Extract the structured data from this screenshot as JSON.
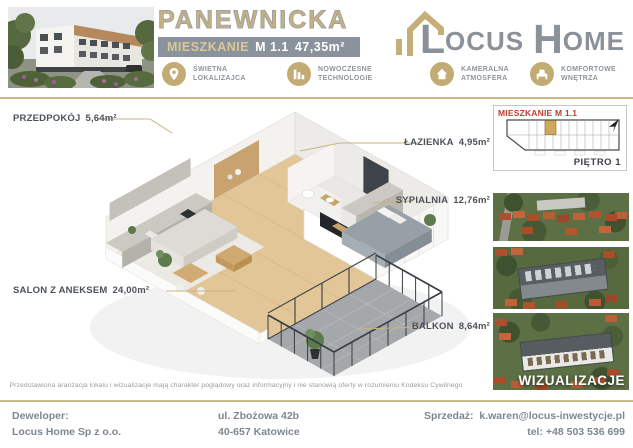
{
  "header": {
    "project_title": "PANEWNICKA",
    "unit_bar": {
      "label": "MIESZKANIE",
      "unit": "M 1.1",
      "area": "47,35m²"
    },
    "logo": {
      "l": "L",
      "ocus": "OCUS",
      "h": "H",
      "ome": "OME"
    },
    "features": [
      {
        "icon": "location-pin-icon",
        "line1": "ŚWIETNA",
        "line2": "LOKALIZAJCA"
      },
      {
        "icon": "bar-chart-icon",
        "line1": "NOWOCZESNE",
        "line2": "TECHNOLOGIE"
      },
      {
        "icon": "house-icon",
        "line1": "KAMERALNA",
        "line2": "ATMOSFERA"
      },
      {
        "icon": "armchair-icon",
        "line1": "KOMFORTOWE",
        "line2": "WNĘTRZA"
      }
    ]
  },
  "floorplan": {
    "labels": [
      {
        "name": "PRZEDPOKÓJ",
        "area": "5,64m²"
      },
      {
        "name": "ŁAZIENKA",
        "area": "4,95m²"
      },
      {
        "name": "SYPIALNIA",
        "area": "12,76m²"
      },
      {
        "name": "SALON Z ANEKSEM",
        "area": "24,00m²"
      },
      {
        "name": "BALKON",
        "area": "8,64m²"
      }
    ],
    "disclaimer": "Przedstawiona aranżacja lokalu i wizualizacje mają charakter poglądowy oraz informacyjny i nie stanowią oferty w rozumieniu Kodeksu Cywilnego"
  },
  "sidebar": {
    "plan_box": {
      "title": "MIESZKANIE M 1.1",
      "floor": "PIĘTRO 1"
    },
    "visuals_label": "WIZUALIZACJE"
  },
  "footer": {
    "developer_label": "Deweloper:",
    "developer_name": "Locus Home Sp z o.o.",
    "address_line1": "ul. Zbożowa 42b",
    "address_line2": "40-657 Katowice",
    "sales_label": "Sprzedaż:",
    "sales_email": "k.waren@locus-inwestycje.pl",
    "sales_phone": "tel: +48  503 536 699"
  },
  "colors": {
    "gold": "#c9b78e",
    "gray": "#8a929b",
    "red": "#c23b2e"
  }
}
